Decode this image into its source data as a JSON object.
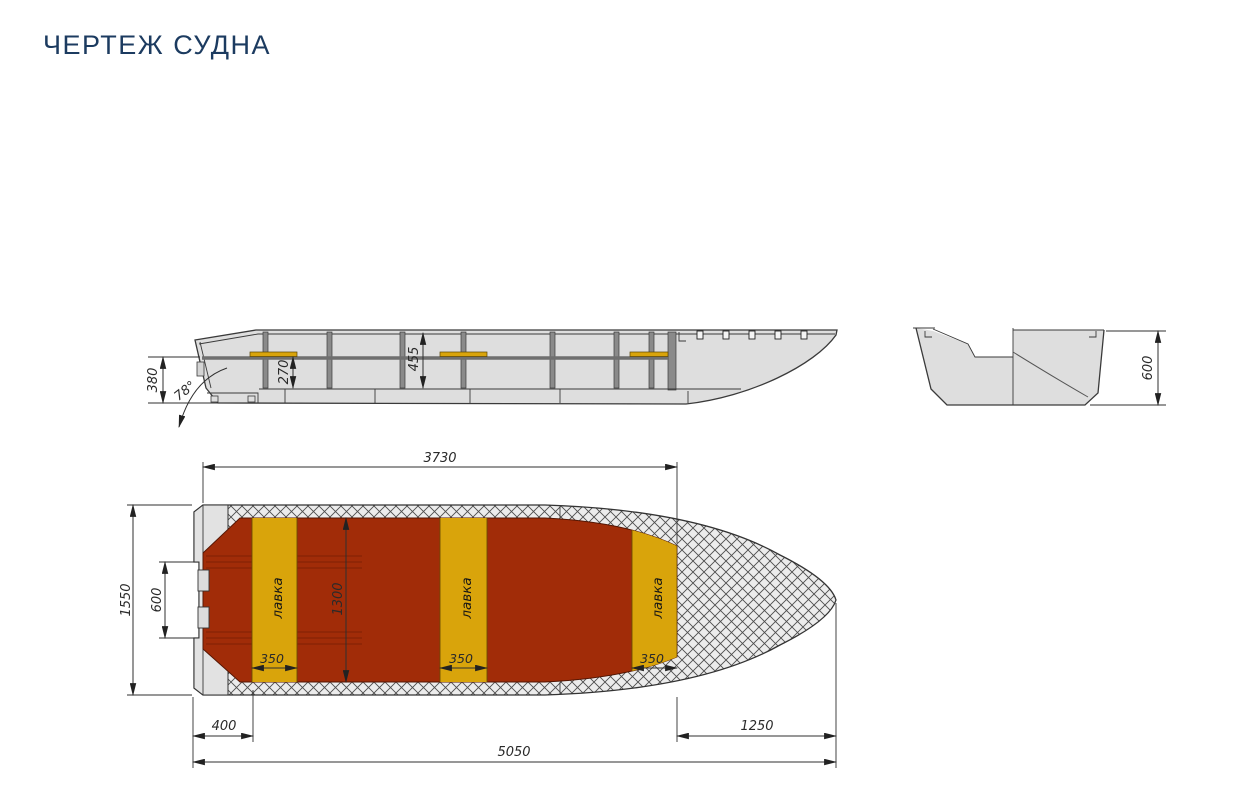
{
  "title": "ЧЕРТЕЖ СУДНА",
  "colors": {
    "title_navy": "#1c3b60",
    "floor_red": "#a12c08",
    "floor_red_dark": "#7e2004",
    "bench_yellow": "#d9a40b",
    "hull_gray": "#dedede",
    "stern_gray": "#e2e2e2",
    "frame_gray": "#8a8a8a",
    "line_dark": "#333333"
  },
  "side_view": {
    "stern_height": "380",
    "transom_angle": "78°",
    "seat_height": "270",
    "depth_midship": "455"
  },
  "cross_section": {
    "board_height": "600"
  },
  "plan_view": {
    "cockpit_length": "3730",
    "overall_width": "1550",
    "transom_recess": "600",
    "cockpit_width": "1300",
    "stern_to_bench": "400",
    "bow_deck_length": "1250",
    "overall_length": "5050",
    "benches": [
      {
        "label": "лавка",
        "width": "350"
      },
      {
        "label": "лавка",
        "width": "350"
      },
      {
        "label": "лавка",
        "width": "350"
      }
    ]
  }
}
